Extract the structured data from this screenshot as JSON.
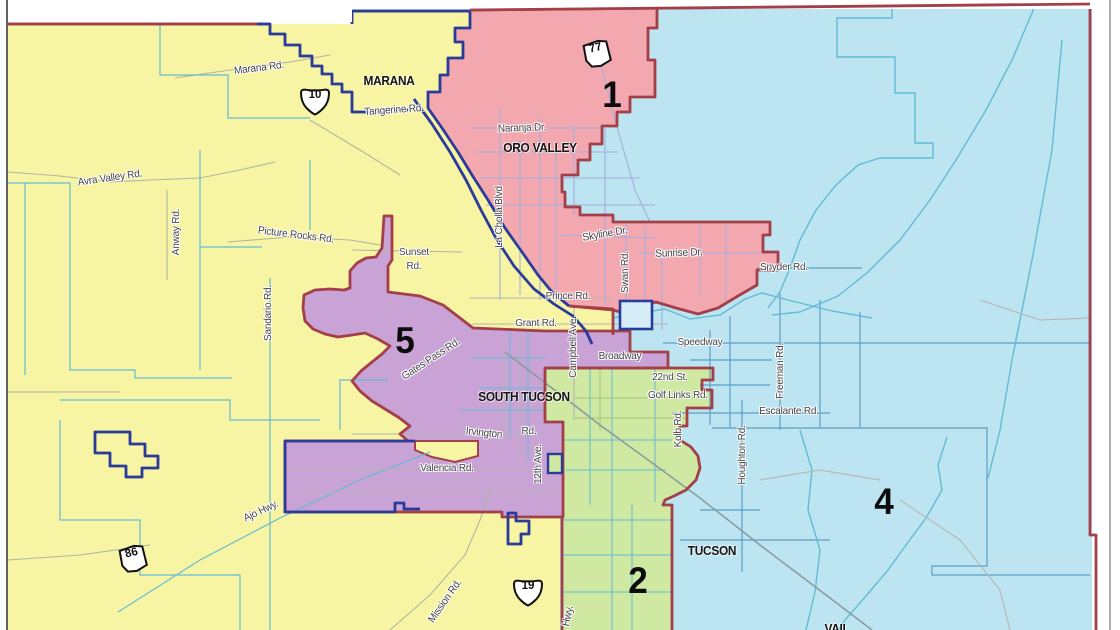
{
  "map_type": "district-map",
  "colors": {
    "district_yellow": "#f7f4a4",
    "district_pink": "#f3a8b0",
    "district_blue": "#bce4f1",
    "district_purple": "#c9a2d6",
    "district_green": "#cfe8a2",
    "district_boundary_red": "#a33f48",
    "municipal_boundary_navy": "#2a3b9a",
    "hydro_cyan": "#62bcd4",
    "road_gray": "#b3b3b3"
  },
  "districts_visible": [
    {
      "number": "1",
      "fill": "pink"
    },
    {
      "number": "2",
      "fill": "green"
    },
    {
      "number": "4",
      "fill": "blue"
    },
    {
      "number": "5",
      "fill": "purple"
    }
  ],
  "district_numbers": {
    "d1": "1",
    "d2": "2",
    "d4": "4",
    "d5": "5"
  },
  "places": {
    "marana": "MARANA",
    "oro_valley": "ORO VALLEY",
    "south_tucson": "SOUTH TUCSON",
    "tucson": "TUCSON",
    "vail": "VAIL"
  },
  "roads": {
    "marana_rd": "Marana Rd.",
    "tangerine_rd": "Tangerine Rd.",
    "avra_valley_rd": "Avra Valley Rd.",
    "anway_rd": "Anway Rd.",
    "picture_rocks_rd": "Picture Rocks Rd.",
    "sandario_rd": "Sandario Rd.",
    "sunset_line1": "Sunset",
    "sunset_line2": "Rd.",
    "la_cholla_blvd": "La Cholla Blvd",
    "naranja_dr": "Naranja Dr.",
    "skyline_dr": "Skyline Dr.",
    "swan_rd": "Swan Rd.",
    "sunrise_dr": "Sunrise Dr.",
    "snyder_rd": "Snyder Rd.",
    "prince_rd": "Prince Rd.",
    "grant_rd": "Grant Rd.",
    "campbell_ave": "Campbell Ave.",
    "broadway": "Broadway",
    "speedway": "Speedway",
    "twentysecond_st": "22nd St.",
    "golf_links_rd": "Golf Links Rd.",
    "freeman_rd": "Freeman Rd.",
    "escalante_rd": "Escalante Rd.",
    "kolb_rd": "Kolb Rd.",
    "houghton_rd": "Houghton Rd.",
    "gates_pass_rd": "Gates Pass Rd.",
    "irvington": "Irvington",
    "irvington_rd": "Rd.",
    "valencia_rd": "Valencia Rd.",
    "twelfth_ave": "12th Ave.",
    "ajo_hwy": "Ajo Hwy.",
    "mission_rd": "Mission Rd.",
    "hwy_partial": "Hwy."
  },
  "shields": {
    "i10": "10",
    "i19": "19",
    "sr77": "77",
    "sr86": "86"
  }
}
